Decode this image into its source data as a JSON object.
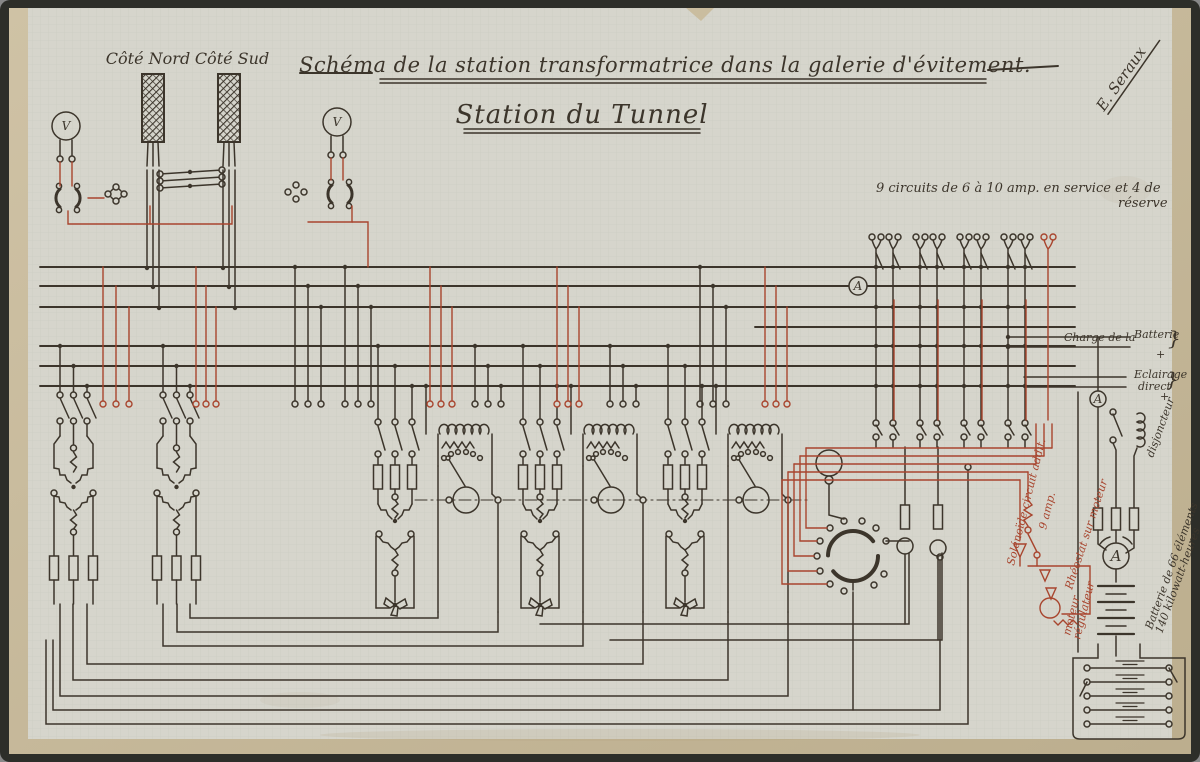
{
  "sheet": {
    "title": "Schéma de la station transformatrice dans la galerie d'évitement.",
    "subtitle": "Station du Tunnel",
    "signature": "E. Seraux",
    "cable_north": "Côté Nord",
    "cable_south": "Côté Sud",
    "note_circuits_1": "9 circuits de 6 à 10 amp. en service et 4 de",
    "note_circuits_2": "réserve",
    "label_charge_1": "Charge de la",
    "label_charge_2": "Batterie",
    "brace": "}",
    "plus": "+",
    "label_eclairage_1": "Eclairage",
    "label_eclairage_2": "direct",
    "label_disjoncteur": "disjoncteur",
    "label_solenoide": "Solénoïde circuit addit.",
    "label_lampe": "9 amp.",
    "label_rheostat": "Rhéostat sur moteur",
    "label_moteur_1": "moteur",
    "label_moteur_2": "régulateur",
    "label_batterie_1": "Batterie de 66 éléments",
    "label_batterie_2": "140 kilowatt-heures",
    "meter_v": "V",
    "meter_a": "A"
  },
  "colors": {
    "ink": "#3c352b",
    "red_ink": "#a8452e",
    "paper": "#d6d5cc",
    "matte": "#c6b695",
    "frame": "#2d2e29"
  }
}
